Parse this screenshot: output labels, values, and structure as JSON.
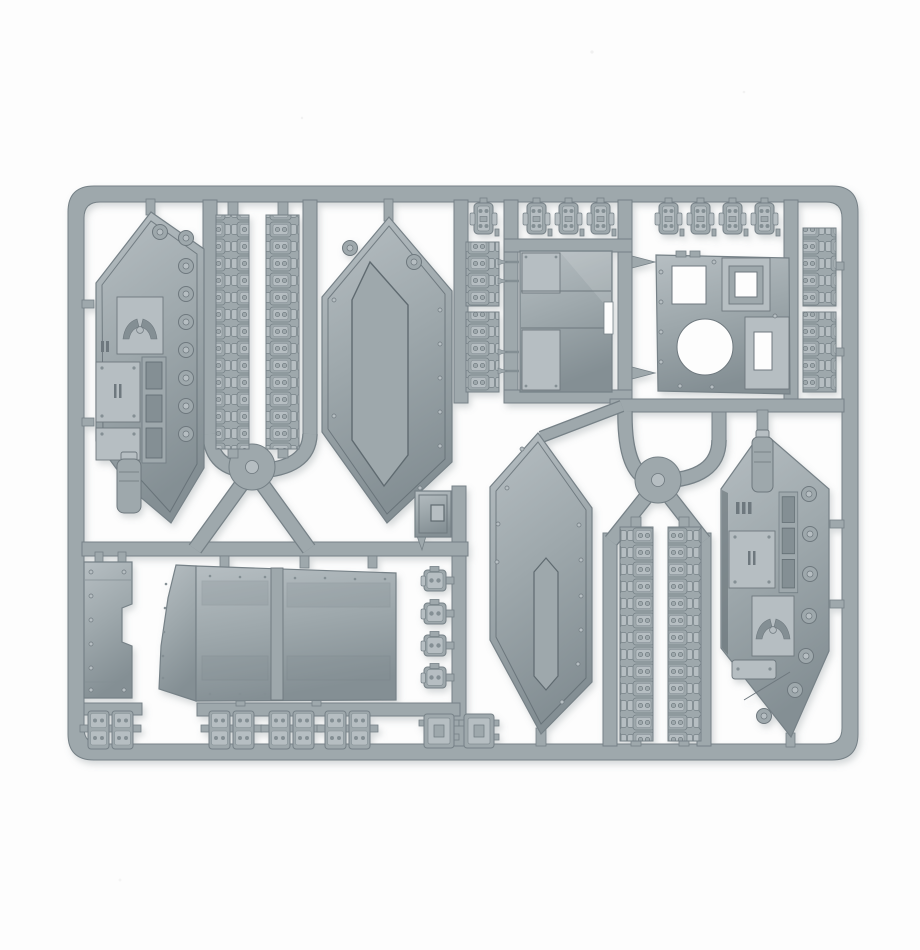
{
  "image": {
    "description": "Grey injection-moulded plastic model kit sprue for a tank vehicle, photographed flat on a white background",
    "object_type": "model-kit-sprue",
    "background_color": "#fdfdfd"
  },
  "colors": {
    "plastic_base": "#9ea8ac",
    "plastic_light": "#b6bec2",
    "plastic_lighter": "#c8cfd2",
    "plastic_dark": "#848f94",
    "plastic_darker": "#6e787e",
    "edge_outline": "#768187",
    "recess_shadow": "#5f6a70",
    "photo_shadow": "#6e7a80"
  },
  "parts_inventory": [
    {
      "id": "left-hull-interior-panel",
      "label": "hull side panel (interior face) with hatch, eagle door and wheel sockets"
    },
    {
      "id": "hull-exterior-side-panel",
      "label": "hull side panel (exterior face) with recessed armour plate"
    },
    {
      "id": "smooth-hex-side-panel",
      "label": "hull side panel (exterior face), smooth with rivets"
    },
    {
      "id": "right-hull-interior-panel",
      "label": "hull side panel (interior face) with III marking"
    },
    {
      "id": "track-run-long",
      "label": "long track run strip (x4)"
    },
    {
      "id": "track-segment-short",
      "label": "short track segment (x4)"
    },
    {
      "id": "track-pad-small",
      "label": "small track pad / hatch piece (x12)"
    },
    {
      "id": "track-link-pair",
      "label": "paired track link pieces (x4)"
    },
    {
      "id": "engine-access-panel",
      "label": "engine deck panel with locating pins"
    },
    {
      "id": "casemate-top-plate",
      "label": "casemate top plate with turret ring hole and hatch openings"
    },
    {
      "id": "small-access-door",
      "label": "small access door"
    },
    {
      "id": "assault-ramp-door",
      "label": "large assault ramp door"
    },
    {
      "id": "narrow-side-skirt",
      "label": "narrow riveted skirt panel"
    },
    {
      "id": "mounting-plate-square",
      "label": "small square mounting plate (x2)"
    }
  ],
  "frame": {
    "shape": "rounded rectangle runner frame with internal runners, two circular hubs and sprue gates",
    "material_color_name": "light grey polystyrene"
  }
}
